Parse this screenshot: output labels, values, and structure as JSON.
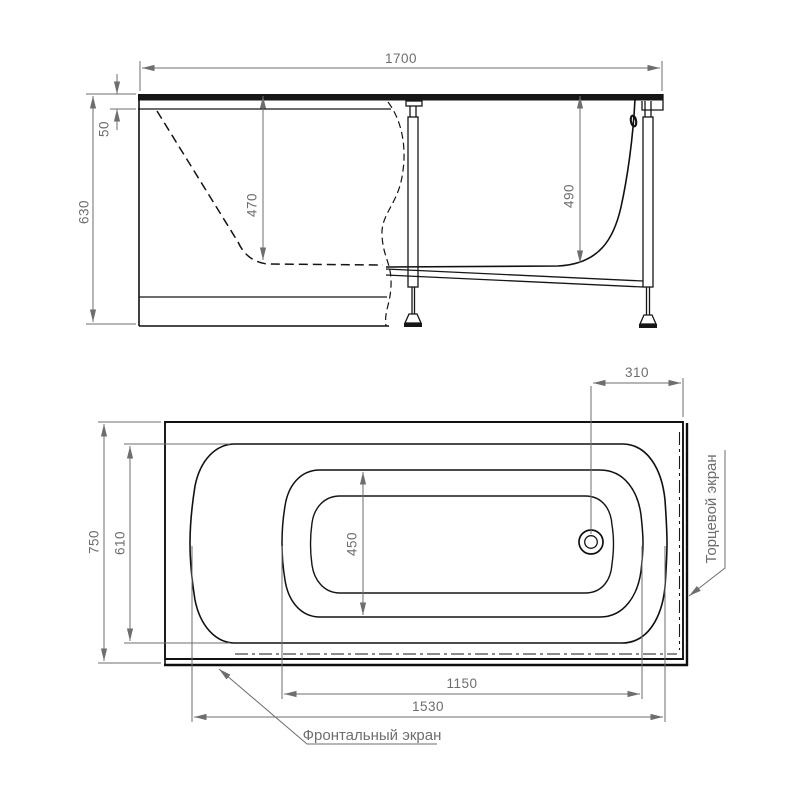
{
  "side_view": {
    "length": "1700",
    "rim_drop": "50",
    "height": "630",
    "inner_depth": "470",
    "frame_height": "490"
  },
  "plan_view": {
    "drain_offset": "310",
    "width": "750",
    "rim_width": "610",
    "bottom_width": "450",
    "bottom_length": "1150",
    "rim_length": "1530",
    "end_screen_label": "Торцевой экран",
    "front_screen_label": "Фронтальный экран"
  }
}
